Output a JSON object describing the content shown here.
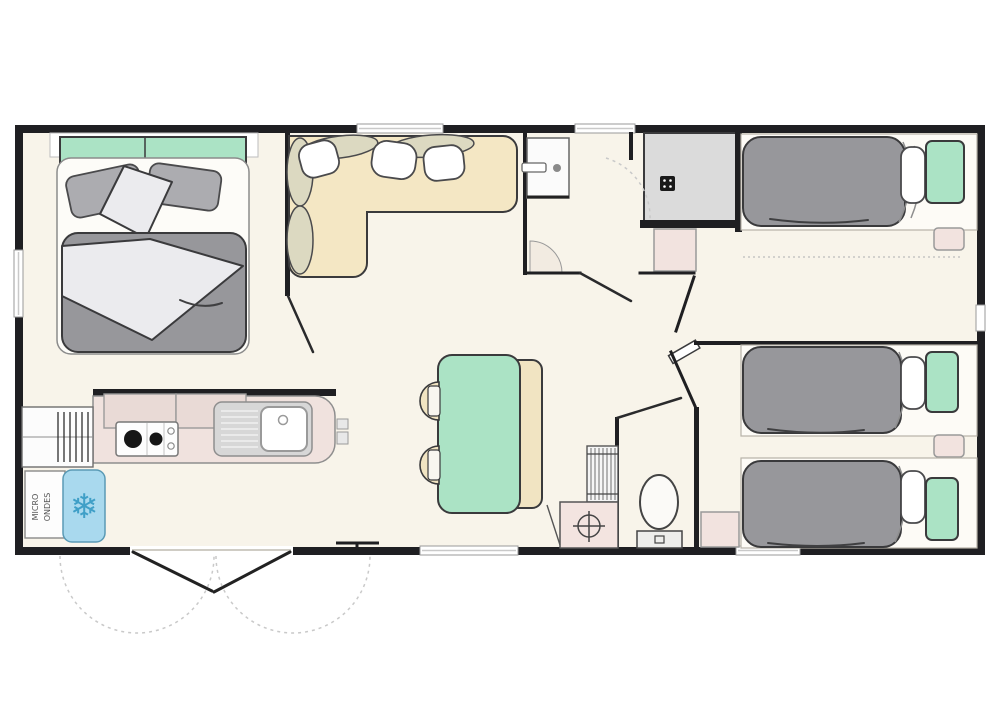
{
  "palette": {
    "wall": "#1f1f22",
    "floor": "#f8f4ea",
    "outline": "#3a3a3c",
    "mint": "#abe3c5",
    "beige": "#f4e7c4",
    "duvet_gray": "#97979b",
    "shower_gray": "#dbdbdb",
    "counter_pink": "#f0e2de",
    "cabinet_pink": "#f2e3df",
    "fridge_blue": "#a9d9ee",
    "window_gray": "#c9c9c9",
    "bolster": "#dcd9c1"
  },
  "labels": {
    "microwave_line1": "MICRO",
    "microwave_line2": "ONDES"
  },
  "icons": {
    "fridge_snowflake": "❄"
  }
}
